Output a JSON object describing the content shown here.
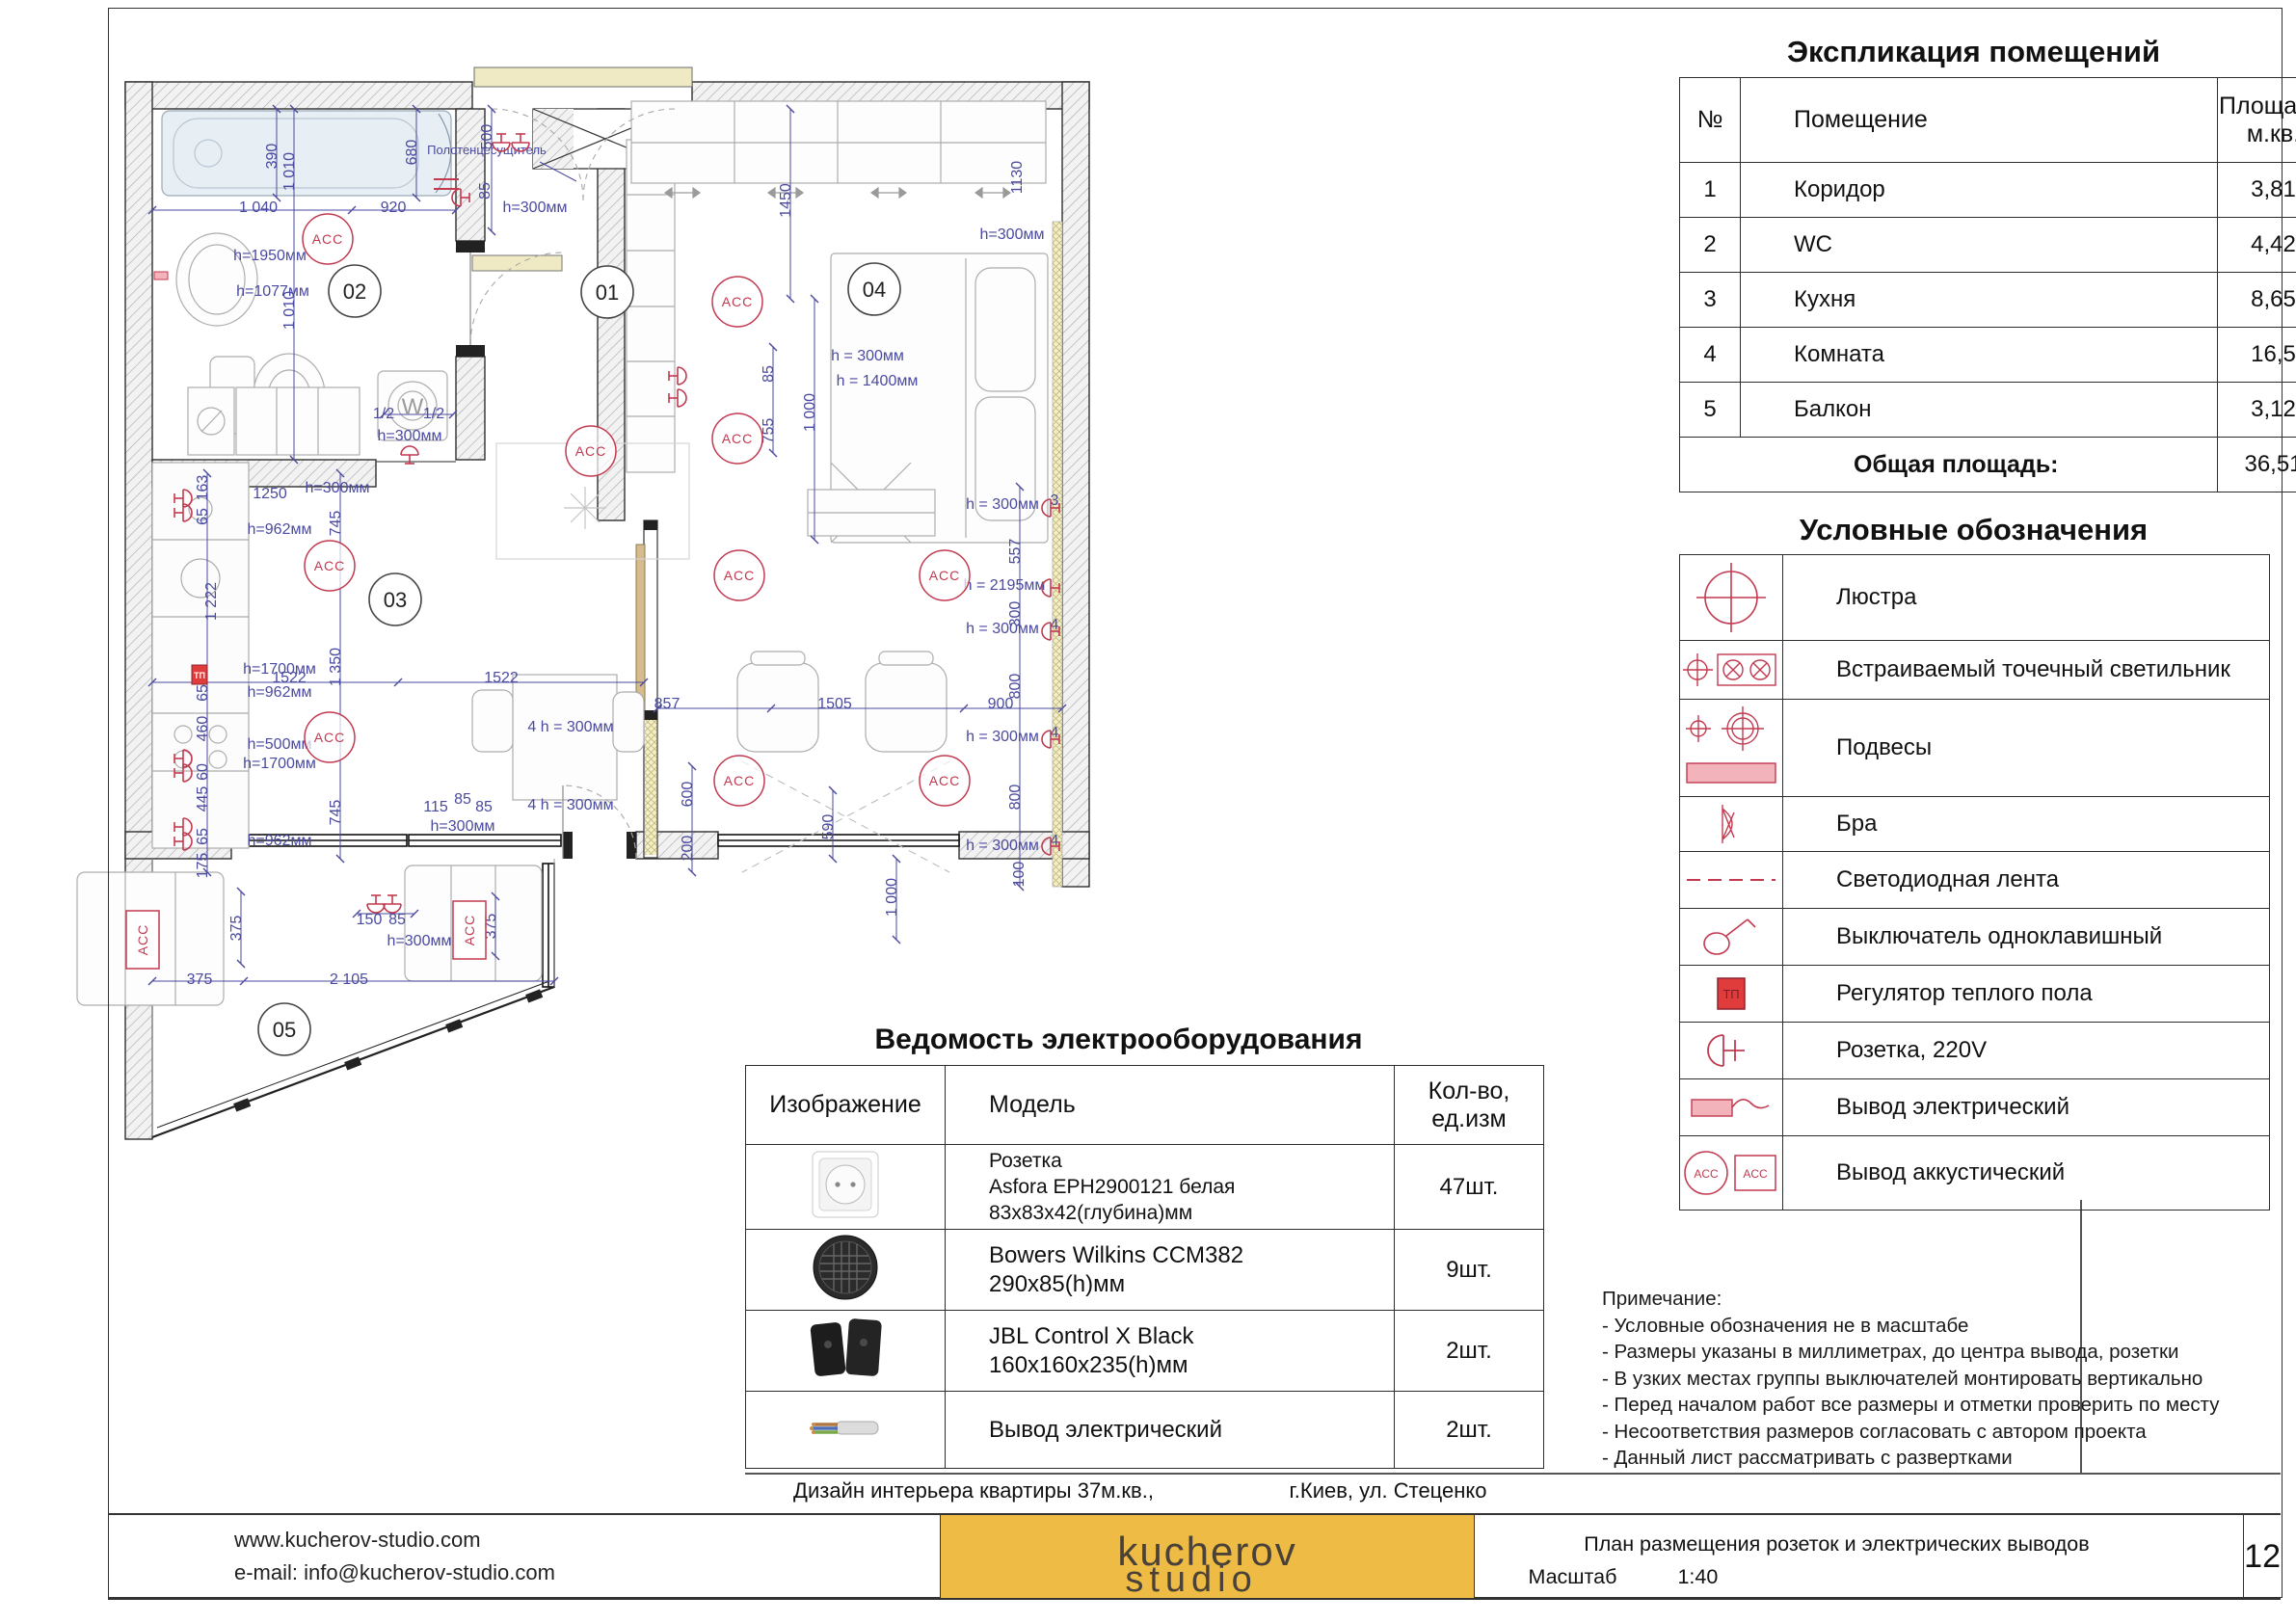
{
  "explication": {
    "title": "Экспликация помещений",
    "col_num": "№",
    "col_room": "Помещение",
    "col_area": "Площадь,\nм.кв.",
    "rows": [
      {
        "num": "1",
        "room": "Коридор",
        "area": "3,81"
      },
      {
        "num": "2",
        "room": "WC",
        "area": "4,42"
      },
      {
        "num": "3",
        "room": "Кухня",
        "area": "8,65"
      },
      {
        "num": "4",
        "room": "Комната",
        "area": "16,5"
      },
      {
        "num": "5",
        "room": "Балкон",
        "area": "3,12"
      }
    ],
    "total_label": "Общая площадь:",
    "total_value": "36,51"
  },
  "legend": {
    "title": "Условные обозначения",
    "items": [
      {
        "icon": "chandelier-icon",
        "label": "Люстра"
      },
      {
        "icon": "recessed-spot-icon",
        "label": "Встраиваемый точечный светильник"
      },
      {
        "icon": "pendant-icon",
        "label": "Подвесы"
      },
      {
        "icon": "sconce-icon",
        "label": "Бра"
      },
      {
        "icon": "led-strip-icon",
        "label": "Светодиодная лента"
      },
      {
        "icon": "switch-icon",
        "label": "Выключатель одноклавишный"
      },
      {
        "icon": "floor-heating-icon",
        "label": "Регулятор теплого пола"
      },
      {
        "icon": "socket-icon",
        "label": "Розетка, 220V"
      },
      {
        "icon": "electric-outlet-icon",
        "label": "Вывод электрический"
      },
      {
        "icon": "acoustic-outlet-icon",
        "label": "Вывод аккустический"
      }
    ]
  },
  "equipment": {
    "title": "Ведомость электрооборудования",
    "col_image": "Изображение",
    "col_model": "Модель",
    "col_qty": "Кол-во,\nед.изм",
    "rows": [
      {
        "model_lines": [
          "Розетка",
          "Asfora EPH2900121 белая",
          "83х83х42(глубина)мм"
        ],
        "qty": "47шт."
      },
      {
        "model_lines": [
          "Bowers Wilkins CCM382",
          "290х85(h)мм"
        ],
        "qty": "9шт."
      },
      {
        "model_lines": [
          "JBL Control X Black",
          "160х160х235(h)мм"
        ],
        "qty": "2шт."
      },
      {
        "model_lines": [
          "Вывод электрический"
        ],
        "qty": "2шт."
      }
    ]
  },
  "caption": {
    "left": "Дизайн интерьера квартиры 37м.кв.,",
    "right": "г.Киев, ул. Стеценко"
  },
  "notes": {
    "title": "Примечание:",
    "lines": [
      "- Условные обозначения не в масштабе",
      "- Размеры указаны в миллиметрах, до центра вывода, розетки",
      "- В узких местах группы выключателей монтировать вертикально",
      "- Перед началом работ все размеры и отметки проверить по месту",
      "- Несоответствия размеров согласовать с автором проекта",
      "- Данный лист рассматривать с развертками"
    ]
  },
  "footer": {
    "website": "www.kucherov-studio.com",
    "email": "e-mail: info@kucherov-studio.com",
    "logo_line1": "kucherov",
    "logo_line2": "studio",
    "doc_title": "План размещения розеток и электрических выводов",
    "scale_label": "Масштаб",
    "scale_value": "1:40",
    "page": "12"
  },
  "colors": {
    "dim_blue": "#4a4aa0",
    "symbol_red": "#c23a50",
    "accent_yellow": "#eebc45",
    "pink_fill": "#f2b3ba",
    "sill_yellow": "#efe9c4"
  },
  "plan": {
    "acc_text": "ACC",
    "tp_label": "ТП",
    "badges": [
      [
        630,
        303,
        "01"
      ],
      [
        368,
        302,
        "02"
      ],
      [
        410,
        622,
        "03"
      ],
      [
        907,
        300,
        "04"
      ],
      [
        295,
        1068,
        "05"
      ]
    ],
    "acc_circles": [
      [
        340,
        248
      ],
      [
        342,
        587
      ],
      [
        342,
        765
      ],
      [
        613,
        468
      ],
      [
        765,
        313
      ],
      [
        765,
        455
      ],
      [
        767,
        597
      ],
      [
        980,
        597
      ],
      [
        767,
        810
      ],
      [
        980,
        810
      ]
    ],
    "acc_rects": [
      [
        148,
        975
      ],
      [
        487,
        965
      ]
    ],
    "sockets": [
      [
        520,
        148,
        90
      ],
      [
        540,
        148,
        90
      ],
      [
        478,
        205,
        180
      ],
      [
        190,
        517,
        0
      ],
      [
        190,
        532,
        0
      ],
      [
        190,
        787,
        0
      ],
      [
        190,
        802,
        0
      ],
      [
        190,
        858,
        0
      ],
      [
        190,
        873,
        0
      ],
      [
        703,
        390,
        0
      ],
      [
        703,
        413,
        0
      ],
      [
        425,
        472,
        270
      ],
      [
        390,
        938,
        90
      ],
      [
        407,
        938,
        90
      ],
      [
        1090,
        527,
        180
      ],
      [
        1090,
        610,
        180
      ],
      [
        1090,
        655,
        180
      ],
      [
        1090,
        767,
        180
      ],
      [
        1090,
        878,
        180
      ]
    ],
    "tp": [
      [
        207,
        700
      ]
    ],
    "labels": [
      [
        505,
        160,
        "Полотенцесущитель",
        "lbl-small"
      ],
      [
        428,
        430,
        "W",
        "lbl-gray"
      ]
    ],
    "dims": [
      [
        287,
        162,
        "390",
        1
      ],
      [
        305,
        178,
        "1 010",
        1
      ],
      [
        305,
        322,
        "1 010",
        1
      ],
      [
        268,
        220,
        "1 040",
        0
      ],
      [
        408,
        220,
        "920",
        0
      ],
      [
        432,
        158,
        "680",
        1
      ],
      [
        280,
        270,
        "h=1950мм",
        0
      ],
      [
        283,
        307,
        "h=1077мм",
        0
      ],
      [
        510,
        142,
        "500",
        1
      ],
      [
        508,
        198,
        "85",
        1
      ],
      [
        555,
        220,
        "h=300мм",
        0
      ],
      [
        398,
        434,
        "1/2",
        0
      ],
      [
        450,
        434,
        "1/2",
        0
      ],
      [
        425,
        457,
        "h=300мм",
        0
      ],
      [
        820,
        208,
        "1450",
        1
      ],
      [
        1060,
        184,
        "1130",
        1
      ],
      [
        1050,
        248,
        "h=300мм",
        0
      ],
      [
        900,
        374,
        "h = 300мм",
        0
      ],
      [
        802,
        388,
        "85",
        1
      ],
      [
        910,
        400,
        "h = 1400мм",
        0
      ],
      [
        802,
        447,
        "755",
        1
      ],
      [
        845,
        428,
        "1 000",
        1
      ],
      [
        215,
        506,
        "163",
        1
      ],
      [
        215,
        536,
        "65",
        1
      ],
      [
        290,
        554,
        "h=962мм",
        0
      ],
      [
        224,
        624,
        "1 222",
        1
      ],
      [
        290,
        699,
        "h=1700мм",
        0
      ],
      [
        215,
        719,
        "65",
        1
      ],
      [
        290,
        723,
        "h=962мм",
        0
      ],
      [
        215,
        756,
        "460",
        1
      ],
      [
        290,
        777,
        "h=500мм",
        0
      ],
      [
        290,
        797,
        "h=1700мм",
        0
      ],
      [
        215,
        801,
        "60",
        1
      ],
      [
        215,
        829,
        "445",
        1
      ],
      [
        215,
        868,
        "65",
        1
      ],
      [
        290,
        877,
        "h=962мм",
        0
      ],
      [
        215,
        898,
        "175",
        1
      ],
      [
        280,
        517,
        "1250",
        0
      ],
      [
        350,
        511,
        "h=300мм",
        0
      ],
      [
        353,
        543,
        "745",
        1
      ],
      [
        353,
        692,
        "1 350",
        1
      ],
      [
        353,
        843,
        "745",
        1
      ],
      [
        300,
        708,
        "1522",
        0
      ],
      [
        520,
        708,
        "1522",
        0
      ],
      [
        692,
        735,
        "857",
        0
      ],
      [
        866,
        735,
        "1505",
        0
      ],
      [
        1038,
        735,
        "900",
        0
      ],
      [
        592,
        759,
        "4 h = 300мм",
        0
      ],
      [
        592,
        840,
        "4 h = 300мм",
        0
      ],
      [
        718,
        824,
        "600",
        1
      ],
      [
        718,
        880,
        "200",
        1
      ],
      [
        864,
        858,
        "590",
        1
      ],
      [
        452,
        842,
        "115",
        0
      ],
      [
        480,
        834,
        "85",
        0
      ],
      [
        502,
        842,
        "85",
        0
      ],
      [
        480,
        862,
        "h=300мм",
        0
      ],
      [
        250,
        963,
        "375",
        1
      ],
      [
        514,
        961,
        "375",
        1
      ],
      [
        383,
        959,
        "150",
        0
      ],
      [
        412,
        959,
        "85",
        0
      ],
      [
        435,
        981,
        "h=300мм",
        0
      ],
      [
        362,
        1021,
        "2 105",
        0
      ],
      [
        207,
        1021,
        "375",
        0
      ],
      [
        1040,
        528,
        "h = 300мм",
        0
      ],
      [
        1094,
        524,
        "3",
        0
      ],
      [
        1058,
        572,
        "557",
        1
      ],
      [
        1042,
        612,
        "h = 2195мм",
        0
      ],
      [
        1058,
        637,
        "300",
        1
      ],
      [
        1040,
        657,
        "h = 300мм",
        0
      ],
      [
        1094,
        653,
        "4",
        0
      ],
      [
        1058,
        712,
        "800",
        1
      ],
      [
        1040,
        769,
        "h = 300мм",
        0
      ],
      [
        1094,
        765,
        "4",
        0
      ],
      [
        1058,
        827,
        "800",
        1
      ],
      [
        1040,
        882,
        "h = 300мм",
        0
      ],
      [
        1094,
        877,
        "4",
        0
      ],
      [
        1062,
        907,
        "100",
        1
      ],
      [
        930,
        931,
        "1 000",
        1
      ]
    ]
  }
}
